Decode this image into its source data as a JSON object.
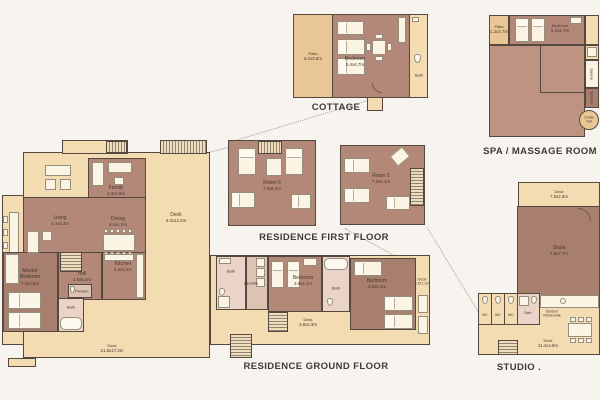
{
  "cottage": {
    "title": "COTTAGE",
    "patio": {
      "name": "Patio",
      "dims": "6.1x3.5m"
    },
    "bedroom": {
      "name": "Bedroom",
      "dims": "5.4x4.7m"
    },
    "bath": {
      "name": "Bath"
    }
  },
  "spa": {
    "title": "SPA / MASSAGE ROOM",
    "patio": {
      "name": "Patio",
      "dims": "1.2x2.7m"
    },
    "bedroom": {
      "name": "Bedroom",
      "dims": "5.2x2.7m"
    },
    "sauna": {
      "name": "Sauna"
    },
    "shower": {
      "name": "Shower"
    },
    "cedar_tub": {
      "name": "Cedar Tub"
    }
  },
  "first_floor": {
    "title": "RESIDENCE FIRST FLOOR",
    "room6": {
      "name": "Room 6",
      "dims": "7.5x6.4m"
    },
    "room5": {
      "name": "Room 5",
      "dims": "7.3x6.4m"
    }
  },
  "ground_floor": {
    "title": "RESIDENCE GROUND FLOOR",
    "family": {
      "name": "Family",
      "dims": "4.4x2.9m"
    },
    "living": {
      "name": "Living",
      "dims": "4.4x4.3m"
    },
    "dining": {
      "name": "Dining",
      "dims": "4.4x4.2m"
    },
    "deck_east": {
      "name": "Deck",
      "dims": "4.3x12.2m"
    },
    "master_bedroom": {
      "name": "Master Bedroom",
      "dims": "7.4x4.8m"
    },
    "hall": {
      "name": "Hall",
      "dims": "2.6x5.2m"
    },
    "kitchen": {
      "name": "Kitchen",
      "dims": "4.2x2.4m"
    },
    "powder": {
      "name": "Powder"
    },
    "bath": {
      "name": "Bath"
    },
    "laundry": {
      "name": "Laundry"
    },
    "bedroom_3": {
      "name": "Bedroom",
      "dims": "3.9x4.1m"
    },
    "bedroom_4": {
      "name": "Bedroom",
      "dims": "3.5x4.4m"
    },
    "deck_side": {
      "name": "Deck",
      "dims": "2.6x7.1m"
    },
    "deck_mid": {
      "name": "Deck",
      "dims": "4.8x2.3m"
    },
    "deck_main": {
      "name": "Deck",
      "dims": "21.6x17.2m"
    }
  },
  "studio": {
    "title": "STUDIO .",
    "deck_top": {
      "name": "Deck",
      "dims": "7.9x2.9m"
    },
    "shala": {
      "name": "Shala",
      "dims": "7.9x7.7m"
    },
    "wc": {
      "name": "WC"
    },
    "bath": {
      "name": "Bath"
    },
    "kitchenette": {
      "name": "Outdoor Kitchenette"
    },
    "deck_bottom": {
      "name": "Deck",
      "dims": "11.4x4.8m"
    }
  }
}
